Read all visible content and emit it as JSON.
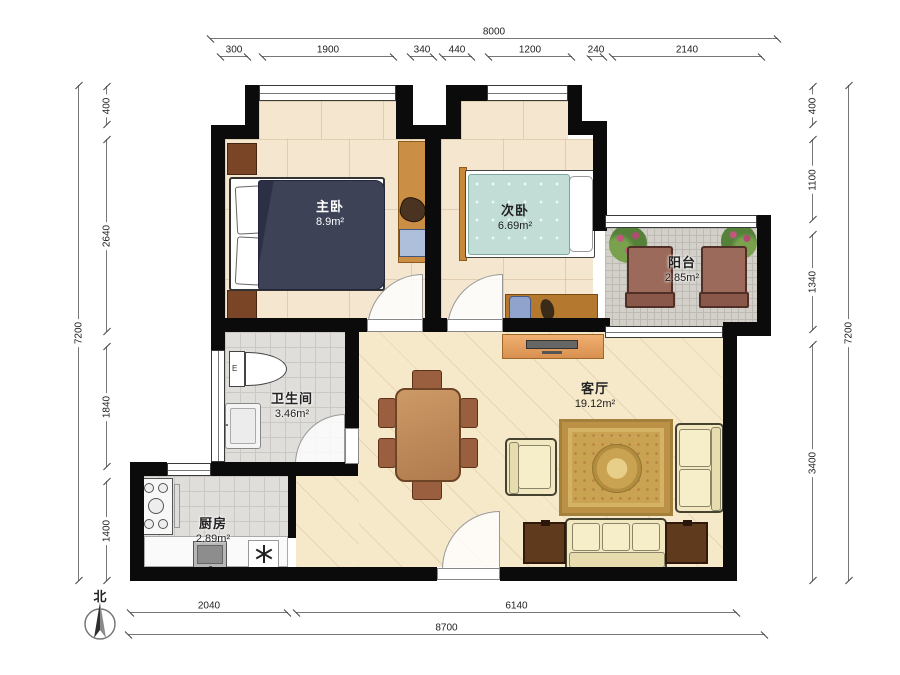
{
  "meta": {
    "type": "apartment-floor-plan"
  },
  "north": {
    "label": "北"
  },
  "rooms": {
    "master_bedroom": {
      "name": "主卧",
      "area": "8.9m²"
    },
    "second_bedroom": {
      "name": "次卧",
      "area": "6.69m²"
    },
    "balcony": {
      "name": "阳台",
      "area": "2.85m²"
    },
    "bathroom": {
      "name": "卫生间",
      "area": "3.46m²",
      "toilet_mark": "E"
    },
    "kitchen": {
      "name": "厨房",
      "area": "2.89m²"
    },
    "living_room": {
      "name": "客厅",
      "area": "19.12m²"
    }
  },
  "dimensions": {
    "top": {
      "total": "8000",
      "segments": [
        "300",
        "1900",
        "340",
        "440",
        "1200",
        "240",
        "2140"
      ]
    },
    "left": {
      "total": "7200",
      "segments": [
        "400",
        "2640",
        "1840",
        "1400"
      ]
    },
    "right": {
      "total": "7200",
      "segments": [
        "400",
        "1100",
        "1340",
        "3400"
      ]
    },
    "bottom": {
      "total": "8700",
      "segments": [
        "2040",
        "6140"
      ]
    }
  },
  "colors": {
    "wall": "#0b0b0b",
    "living_floor": "#f6e9ca",
    "bedroom_floor": "#f4e6cf",
    "tile_floor": "#e0dedb",
    "balcony_tile": "#d3d0ca",
    "master_duvet": "#3e4257",
    "second_duvet": "#c2ddd6",
    "wood": "#c8893b",
    "sofa": "#f1e8c2",
    "rug": "#c9a352"
  },
  "icons": {
    "compass": "north-compass-icon",
    "drain": "asterisk-drain-icon"
  }
}
